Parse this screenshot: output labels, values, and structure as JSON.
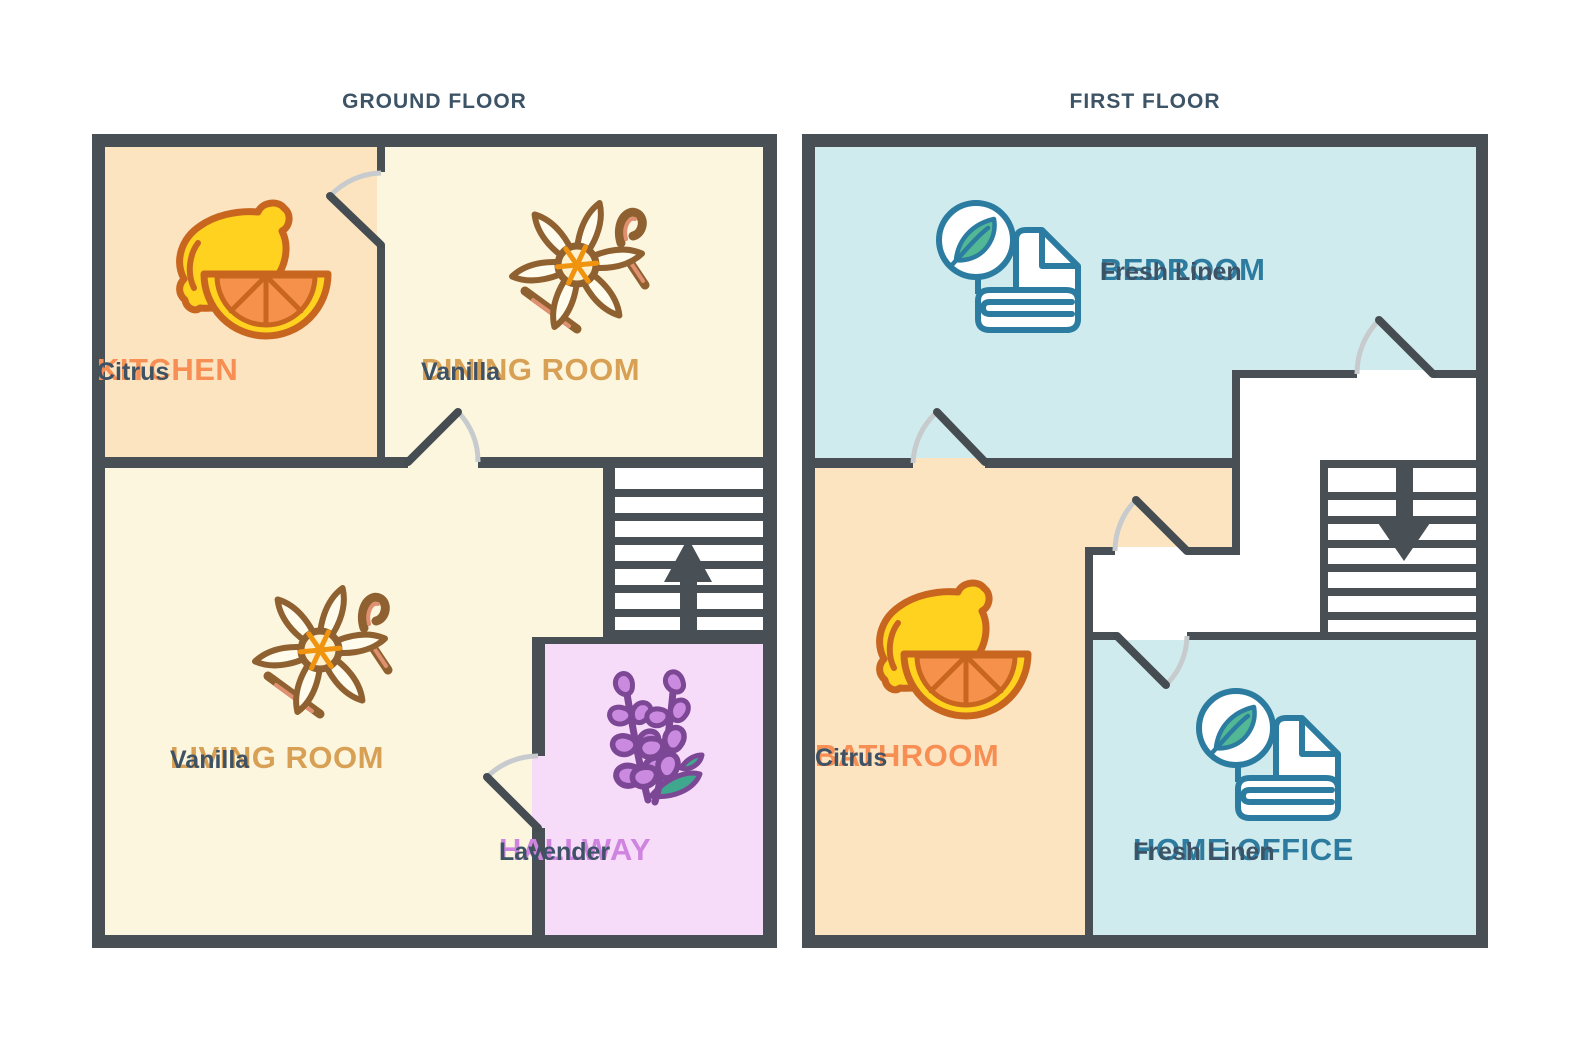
{
  "ground_floor": {
    "title": "GROUND FLOOR",
    "rooms": {
      "kitchen": {
        "name": "KITCHEN",
        "scent": "Citrus"
      },
      "dining": {
        "name": "DINING ROOM",
        "scent": "Vanilla"
      },
      "living": {
        "name": "LIVING ROOM",
        "scent": "Vanilla"
      },
      "hallway": {
        "name": "HALLWAY",
        "scent": "Lavender"
      }
    },
    "stairs_direction": "up"
  },
  "first_floor": {
    "title": "FIRST FLOOR",
    "rooms": {
      "bedroom": {
        "name": "BEDROOM",
        "scent": "Fresh Linen"
      },
      "bathroom": {
        "name": "BATHROOM",
        "scent": "Citrus"
      },
      "office": {
        "name": "HOME OFFICE",
        "scent": "Fresh Linen"
      }
    },
    "stairs_direction": "down"
  },
  "icons": {
    "citrus": "citrus-lemon-icon",
    "vanilla": "vanilla-flower-icon",
    "lavender": "lavender-sprigs-icon",
    "linen": "fresh-linen-icon",
    "up_arrow": "stairs-up-arrow-icon",
    "down_arrow": "stairs-down-arrow-icon"
  },
  "colors": {
    "wall": "#485055",
    "kitchen_bathroom_fill": "#fce4c1",
    "dining_living_fill": "#fcf6df",
    "hallway_fill": "#f7dcfa",
    "bedroom_office_fill": "#cfebed",
    "stairs_fill": "#ffffff",
    "label_orange": "#f78e54",
    "label_tan": "#d8a055",
    "label_purple": "#cf84e0",
    "label_teal": "#2d7ca0",
    "scent_text": "#3e5265",
    "door_arc": "#c7cbcd",
    "lemon_yellow": "#ffd21f",
    "lemon_outline": "#c8661f",
    "orange_flesh": "#f5914a",
    "vanilla_brown": "#8f6130",
    "vanilla_salmon": "#e09070",
    "vanilla_center_orange": "#f0940f",
    "lavender_stroke": "#7c4794",
    "lavender_fill": "#c98ae0",
    "leaf_teal": "#3fa78e",
    "linen_stroke": "#2b7ca0",
    "linen_leaf_green": "#52b794"
  }
}
